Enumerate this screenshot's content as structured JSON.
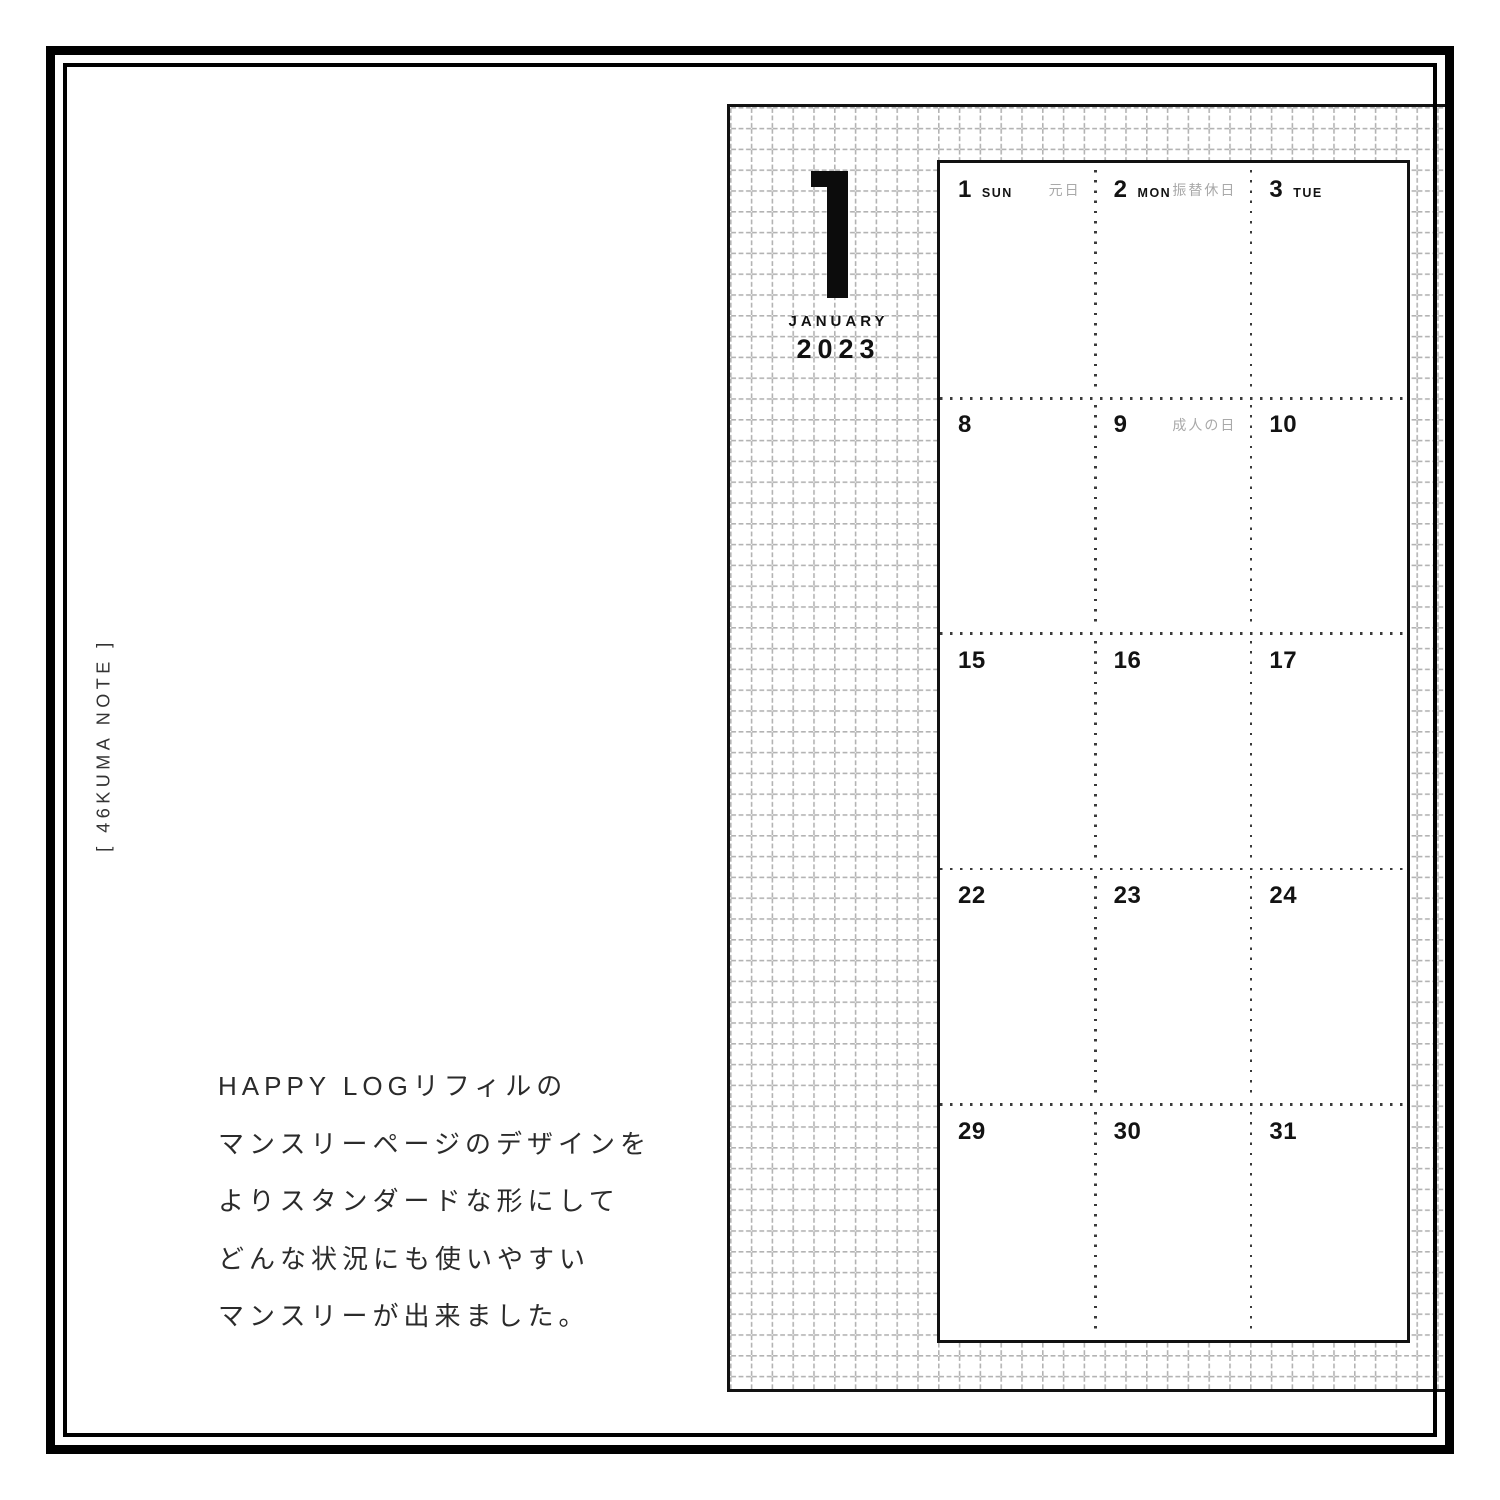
{
  "brand": {
    "vertical_label": "[ 46KUMA NOTE ]"
  },
  "description": {
    "lines": [
      "HAPPY LOGリフィルの",
      "マンスリーページのデザインを",
      "よりスタンダードな形にして",
      "どんな状況にも使いやすい",
      "マンスリーが出来ました。"
    ]
  },
  "calendar": {
    "month_numeral": "1",
    "month_name": "JANUARY",
    "year": "2023",
    "weeks": [
      {
        "days": [
          {
            "num": "1",
            "dow": "SUN",
            "holiday": "元日"
          },
          {
            "num": "2",
            "dow": "MON",
            "holiday": "振替休日"
          },
          {
            "num": "3",
            "dow": "TUE"
          }
        ]
      },
      {
        "days": [
          {
            "num": "8"
          },
          {
            "num": "9",
            "holiday": "成人の日"
          },
          {
            "num": "10"
          }
        ]
      },
      {
        "days": [
          {
            "num": "15"
          },
          {
            "num": "16"
          },
          {
            "num": "17"
          }
        ]
      },
      {
        "days": [
          {
            "num": "22"
          },
          {
            "num": "23"
          },
          {
            "num": "24"
          }
        ]
      },
      {
        "days": [
          {
            "num": "29"
          },
          {
            "num": "30"
          },
          {
            "num": "31"
          }
        ]
      }
    ],
    "colors": {
      "ink": "#121212",
      "holiday_text": "#a9a9a9",
      "grid_line": "#b3b3b3",
      "dot_line": "#3a3a3a"
    }
  }
}
